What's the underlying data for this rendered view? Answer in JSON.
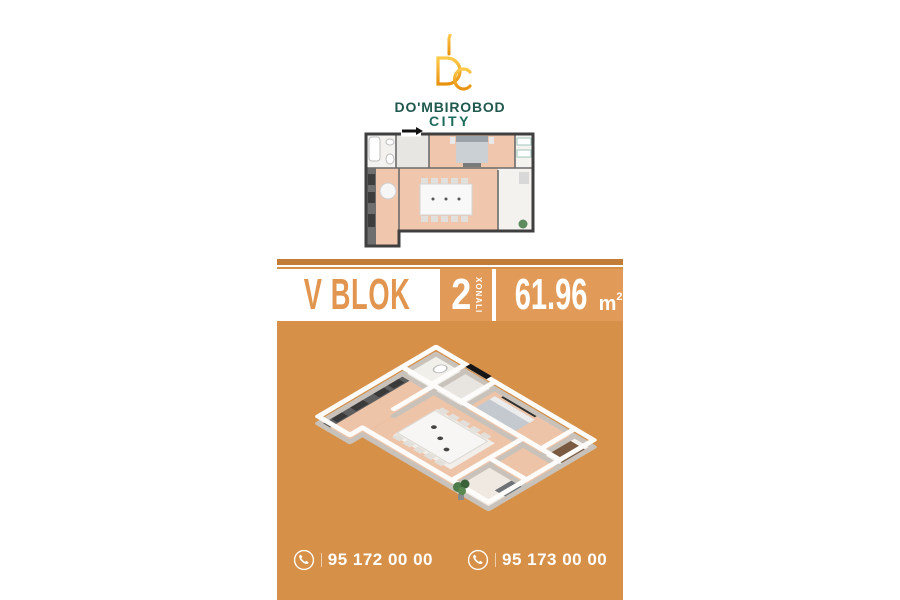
{
  "brand": {
    "logo_icon": "dc-monogram-icon",
    "line1": "DO'MBIROBOD",
    "line2": "CITY"
  },
  "offer": {
    "block_label": "V BLOK",
    "rooms_count": "2",
    "rooms_word": "XONALI",
    "area_value": "61.96",
    "area_unit": "m",
    "area_exponent": "2"
  },
  "contacts": {
    "items": [
      {
        "icon": "phone-icon",
        "number": "95 172 00 00"
      },
      {
        "icon": "phone-icon",
        "number": "95 173 00 00"
      }
    ]
  },
  "floorplans": {
    "top_plan": "2d-top-down-floorplan",
    "main_plan": "3d-isometric-floorplan",
    "rooms": [
      "bathroom",
      "hallway",
      "bedroom",
      "wardrobe",
      "kitchen",
      "dining-room",
      "balcony"
    ]
  },
  "colors": {
    "card_orange": "#D79048",
    "header_orange": "#E29A58",
    "topbar_orange": "#C17C38",
    "accent_orange_text": "#E2954F",
    "brand_teal": "#20584E",
    "logo_gold_dark": "#E8920F",
    "logo_gold_light": "#FFC94A",
    "white": "#FFFFFF"
  }
}
